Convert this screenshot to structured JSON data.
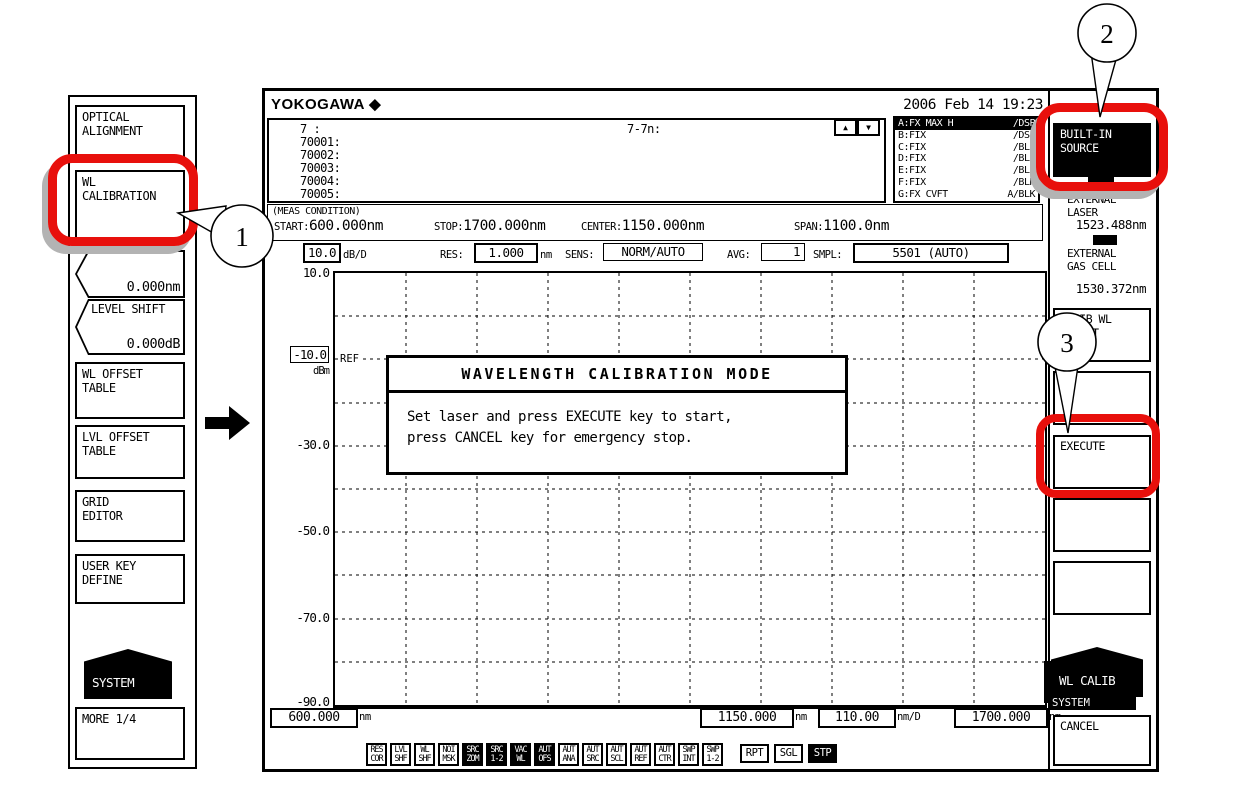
{
  "colors": {
    "highlight_red": "#e8100c",
    "key_black": "#000000",
    "shadow_gray": "#b3b3b3"
  },
  "callouts": {
    "step1": "1",
    "step2": "2",
    "step3": "3"
  },
  "left_panel": {
    "optical_alignment": "OPTICAL\nALIGNMENT",
    "wl_calibration": "WL\nCALIBRATION",
    "wl_shift_value": "0.000nm",
    "level_shift_label": "LEVEL SHIFT",
    "level_shift_value": "0.000dB",
    "wl_offset_table": "WL OFFSET\nTABLE",
    "lvl_offset_table": "LVL OFFSET\nTABLE",
    "grid_editor": "GRID\nEDITOR",
    "user_key_define": "USER KEY\nDEFINE",
    "system_label": "SYSTEM",
    "more_label": "MORE 1/4"
  },
  "screen": {
    "brand": "YOKOGAWA ◆",
    "datetime": "2006 Feb 14 19:23",
    "labels": {
      "rows": [
        "7    :",
        "70001:",
        "70002:",
        "70003:",
        "70004:",
        "70005:"
      ],
      "trace_formula": "7-7n:"
    },
    "icons": {
      "up": "▲",
      "down": "▼"
    },
    "traces": {
      "rows": [
        {
          "left": "A:FX MAX H",
          "right": "/DSP"
        },
        {
          "left": "B:FIX",
          "right": "/DSP"
        },
        {
          "left": "C:FIX",
          "right": "/BLK"
        },
        {
          "left": "D:FIX",
          "right": "/BLK"
        },
        {
          "left": "E:FIX",
          "right": "/BLK"
        },
        {
          "left": "F:FIX",
          "right": "/BLK"
        },
        {
          "left": "G:FX CVFT",
          "right": "A/BLK"
        }
      ]
    },
    "meas": {
      "title": "(MEAS CONDITION)",
      "start_label": "START:",
      "start_value": "600.000nm",
      "stop_label": "STOP:",
      "stop_value": "1700.000nm",
      "center_label": "CENTER:",
      "center_value": "1150.000nm",
      "span_label": "SPAN:",
      "span_value": "1100.0nm"
    },
    "params": {
      "scale_value": "10.0",
      "scale_unit": "dB/D",
      "res_label": "RES:",
      "res_value": "1.000",
      "res_unit": "nm",
      "sens_label": "SENS:",
      "sens_value": "NORM/AUTO",
      "avg_label": "AVG:",
      "avg_value": "1",
      "smpl_label": "SMPL:",
      "smpl_value": "5501 (AUTO)"
    },
    "graph": {
      "y_top": "10.0",
      "y_ref": "-10.0",
      "y_unit": "dBm",
      "ref_marker": "REF",
      "y_30": "-30.0",
      "y_50": "-50.0",
      "y_70": "-70.0",
      "y_90": "-90.0",
      "x_start": "600.000",
      "x_start_unit": "nm",
      "x_center": "1150.000",
      "x_center_unit": "nm",
      "x_scale": "110.00",
      "x_scale_unit": "nm/D",
      "x_stop": "1700.000",
      "x_stop_unit": "nm"
    },
    "dialog": {
      "title": "WAVELENGTH CALIBRATION MODE",
      "line1": "Set laser and press EXECUTE key to start,",
      "line2": "press CANCEL key for emergency stop."
    },
    "status_bar": {
      "icons": [
        {
          "text": "RES\nCOR"
        },
        {
          "text": "LVL\nSHF"
        },
        {
          "text": "WL\nSHF"
        },
        {
          "text": "NOI\nMSK"
        },
        {
          "text": "SRC\nZOM"
        },
        {
          "text": "SRC\n1-2"
        },
        {
          "text": "VAC\nWL"
        },
        {
          "text": "AUT\nOFS"
        },
        {
          "text": "AUT\nANA"
        },
        {
          "text": "AUT\nSRC"
        },
        {
          "text": "AUT\nSCL"
        },
        {
          "text": "AUT\nREF"
        },
        {
          "text": "AUT\nCTR"
        },
        {
          "text": "SWP\nINT"
        },
        {
          "text": "SWP\n1-2"
        }
      ],
      "sweep": [
        {
          "text": "RPT"
        },
        {
          "text": "SGL"
        },
        {
          "text": "STP"
        }
      ]
    }
  },
  "right_panel": {
    "builtin_source": "BUILT-IN\nSOURCE",
    "external_laser_label": "EXTERNAL\nLASER",
    "external_laser_value": "1523.488nm",
    "external_gas_label": "EXTERNAL\nGAS CELL",
    "external_gas_value": "1530.372nm",
    "calib_wl_select": "CALIB WL\nSELECT",
    "execute_label": "EXECUTE",
    "wl_calib_label": "WL CALIB",
    "system_label": "SYSTEM",
    "cancel_label": "CANCEL"
  }
}
